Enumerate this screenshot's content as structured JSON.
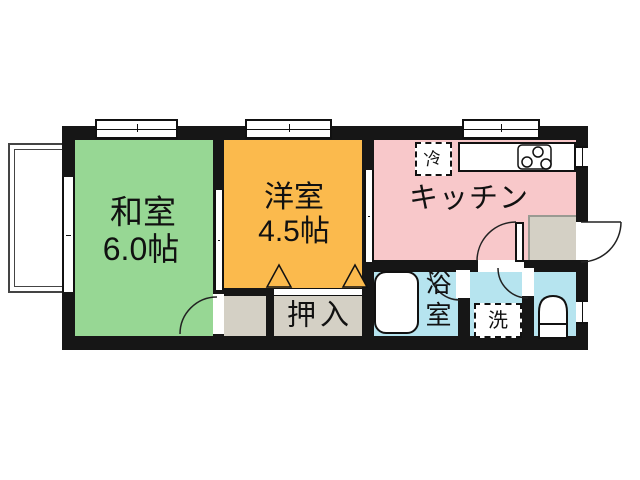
{
  "plan": {
    "type": "apartment-floor-plan",
    "rooms": {
      "washitsu": {
        "label": "和室",
        "area": "6.0帖"
      },
      "yoshitsu": {
        "label": "洋室",
        "area": "4.5帖"
      },
      "kitchen": {
        "label": "キッチン"
      },
      "oshiire": {
        "label": "押入"
      },
      "bathroom": {
        "label": "浴室"
      }
    },
    "fixtures": {
      "refrigerator": {
        "label": "冷"
      },
      "washer": {
        "label": "洗"
      }
    }
  },
  "colors": {
    "wall": "#161616",
    "washitsu": "#97d794",
    "yoshitsu": "#fbba4d",
    "kitchen": "#f8c8ca",
    "sanitary": "#b6e4ef",
    "closet": "#d4d0c5",
    "white": "#ffffff"
  }
}
